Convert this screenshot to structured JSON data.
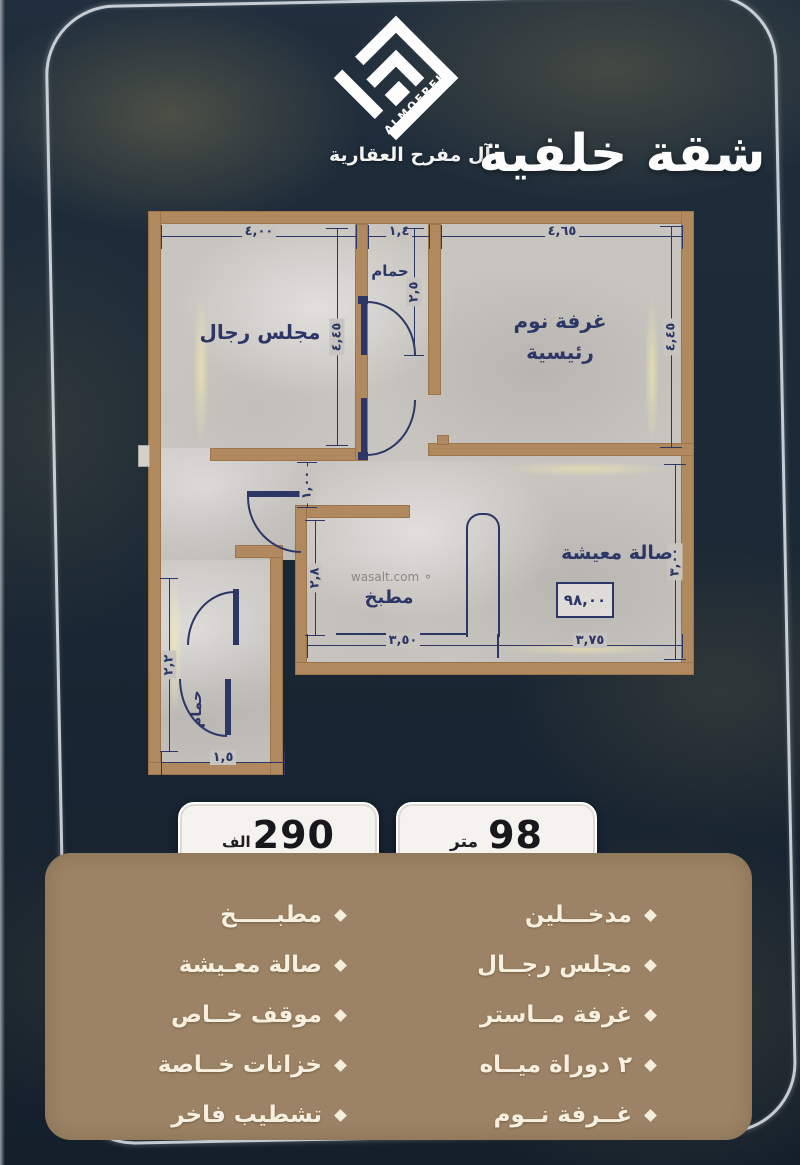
{
  "brand": {
    "logo_text": "ALMOFREH",
    "name": "آل مفرح العقارية"
  },
  "title": "شقة خلفية",
  "plan": {
    "watermark": "wasalt.com",
    "rooms": {
      "majlis": "مجلس رجال",
      "bath_top": "حمام",
      "master_l1": "غرفة نوم",
      "master_l2": "رئيسية",
      "living": "صالة معيشة",
      "kitchen": "مطبخ",
      "bath_bottom": "حمام"
    },
    "area_box": "٩٨,٠٠",
    "dims": {
      "majlis_w": "٤,٠٠",
      "bath_w": "١,٤",
      "master_w": "٤,٦٥",
      "master_h": "٤,٤٥",
      "majlis_h": "٤,٤٥",
      "bath_h": "٢,٥",
      "hall_w": "١,٠٠",
      "kitchen_h": "٢,٨",
      "kitchen_w": "٣,٥٠",
      "living_w": "٣,٧٥",
      "living_h": "٣,٠٠",
      "bath2_w": "١,٥",
      "bath2_h": "٢,٢"
    }
  },
  "badges": {
    "area": {
      "value": "98",
      "unit": "متر"
    },
    "price": {
      "value": "290",
      "unit": "الف"
    }
  },
  "features": {
    "right": [
      "مدخـــلين",
      "مجلس رجــال",
      "غرفة مــاستر",
      "٢ دوراة ميــاه",
      "غــرفة نــوم"
    ],
    "left": [
      "مطبـــــخ",
      "صالة معـيشة",
      "موقف خــاص",
      "خزانات خــاصة",
      "تشطيب فاخر"
    ]
  },
  "colors": {
    "background": "#1c2836",
    "wall": "#b1895e",
    "panel": "#9c8365",
    "plan_line": "#2c3766",
    "cream_text": "#f7f0e1",
    "badge_bg": "#f5f3ef"
  }
}
